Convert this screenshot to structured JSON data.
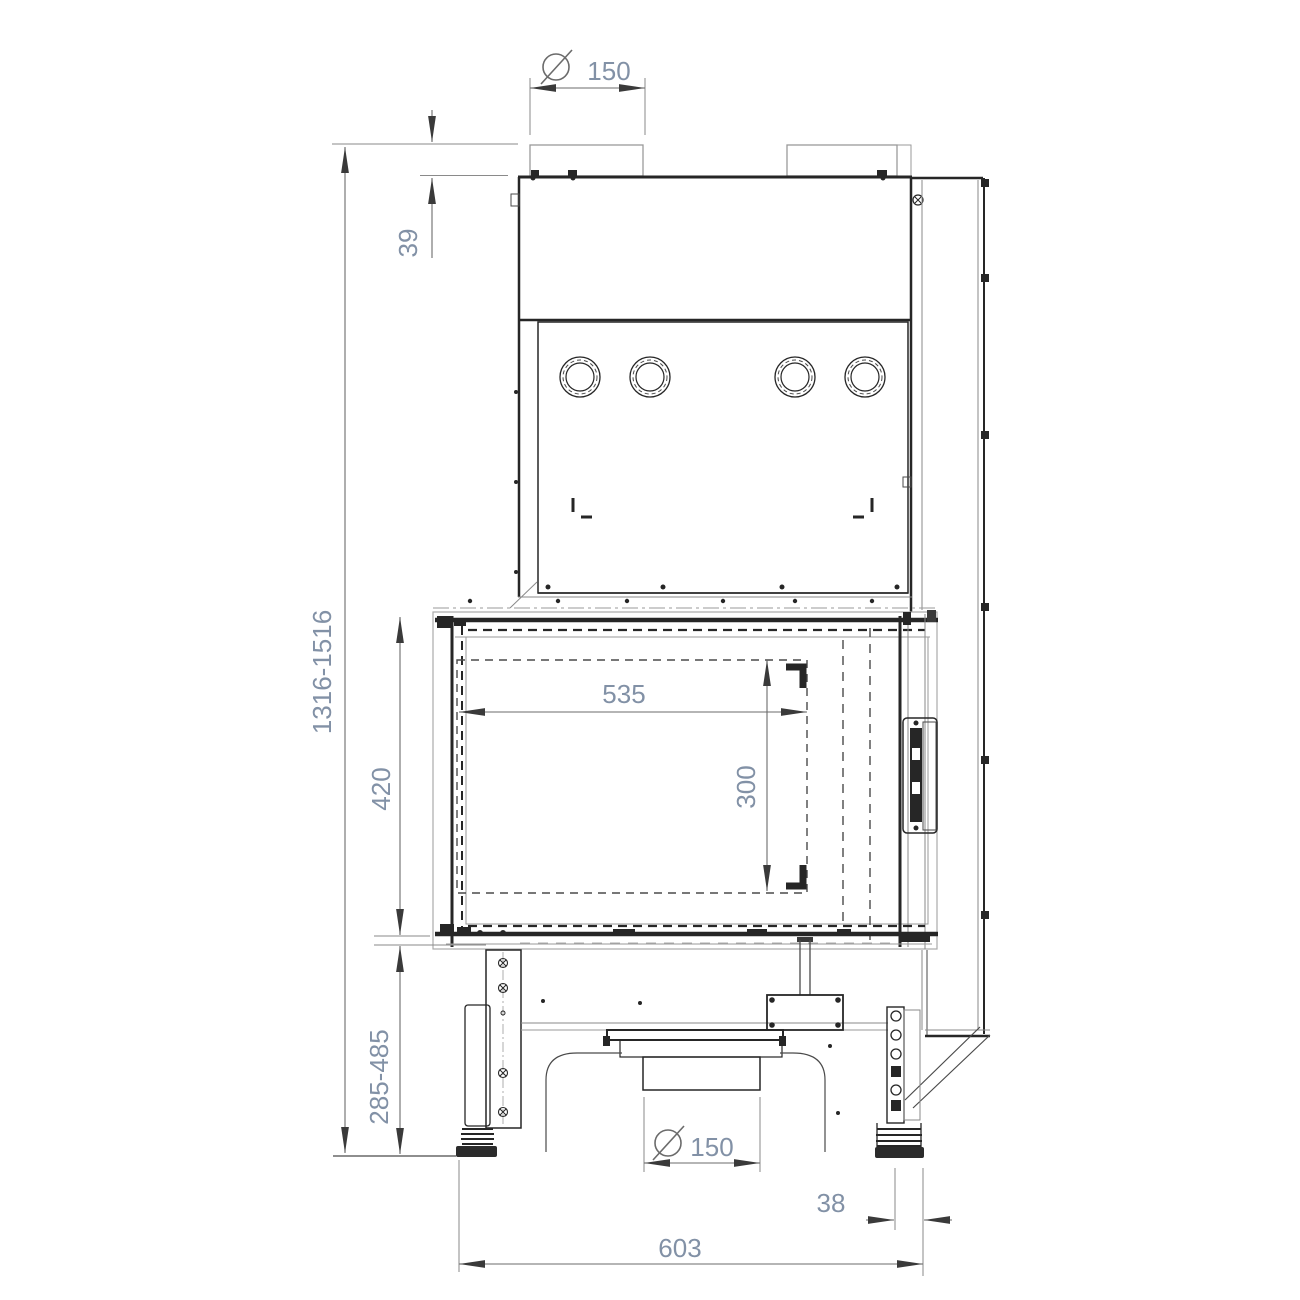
{
  "drawing": {
    "title": "fireplace-insert-front-dimension-drawing",
    "dimensions": {
      "flue_diameter_top": "150",
      "collar_height": "39",
      "total_height_range": "1316-1516",
      "door_frame_height": "420",
      "opening_width": "535",
      "opening_height": "300",
      "base_height_range": "285-485",
      "air_intake_diameter": "150",
      "side_offset": "38",
      "base_width": "603"
    },
    "colors": {
      "dimension_text": "#8291a6",
      "object_line_dark": "#262626",
      "object_line_light": "#8a8a8a",
      "dimension_line": "#6b6b6b"
    }
  }
}
